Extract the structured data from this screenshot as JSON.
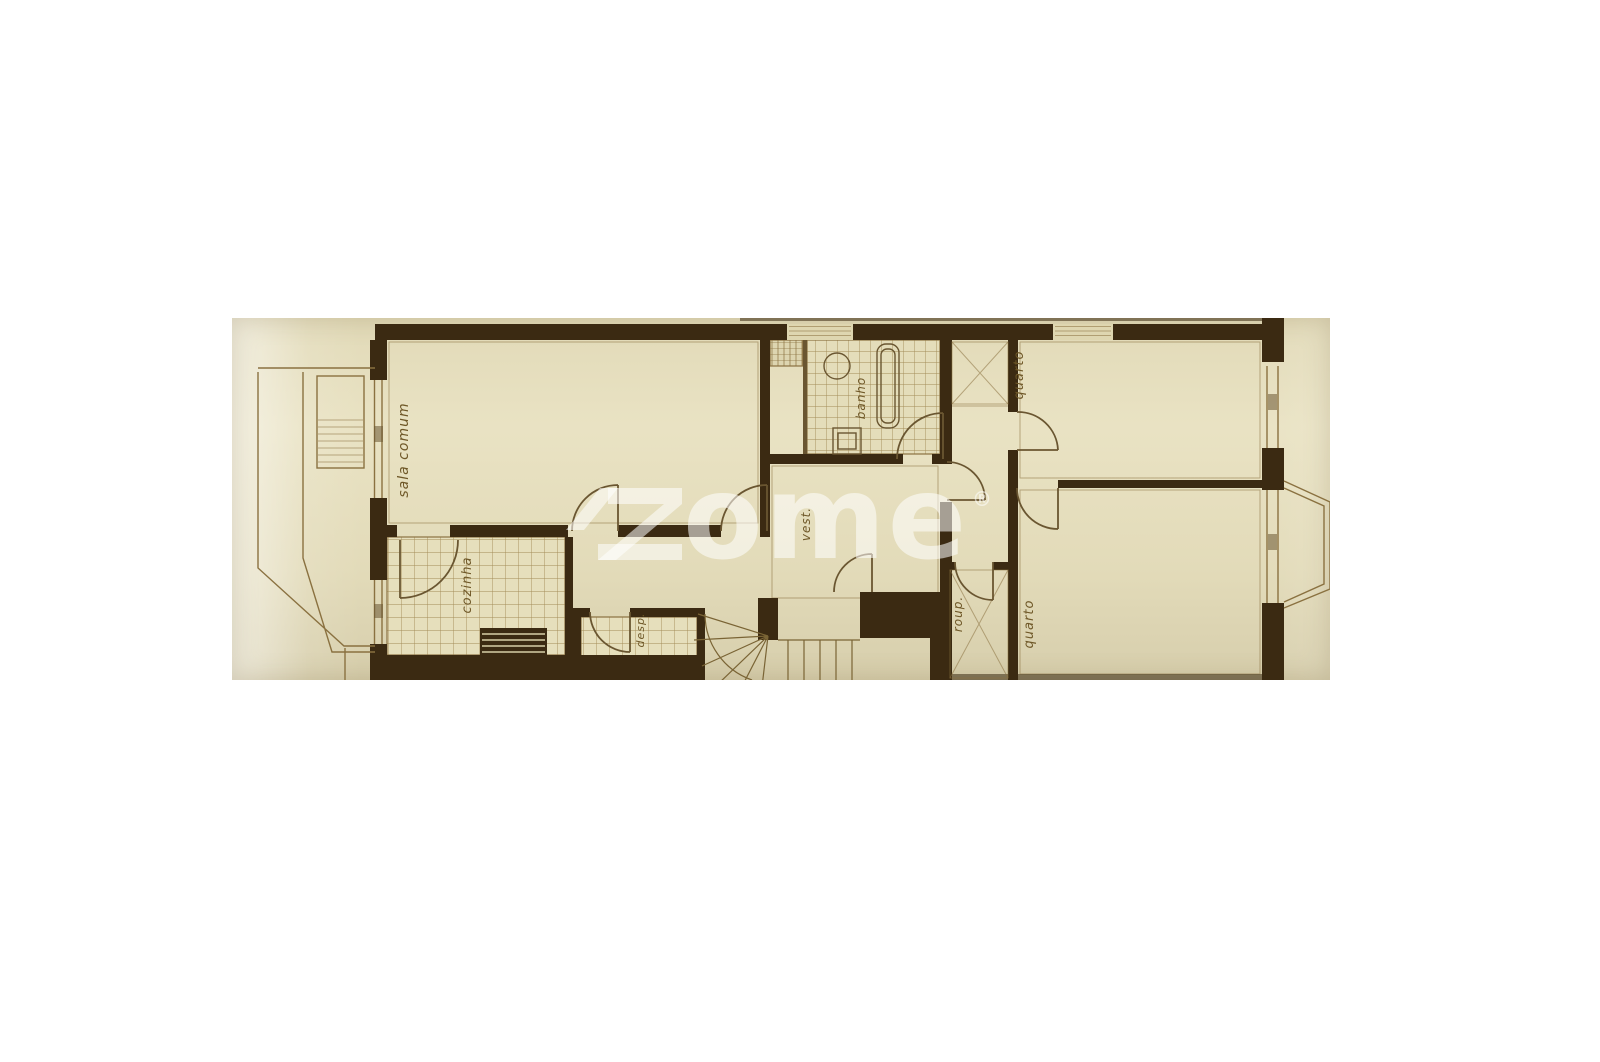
{
  "colors": {
    "page_bg": "#ffffff",
    "photo_bg": "#e8e1c0",
    "wall": "#3b2a12",
    "line": "#8a7140",
    "tile_line": "#a28b56",
    "label": "#6f5828",
    "watermark": "rgba(255,255,255,0.55)"
  },
  "photo": {
    "type": "scanned-floor-plan-photo"
  },
  "floorplan": {
    "rooms": [
      {
        "id": "sala-comum",
        "label": "sala comum"
      },
      {
        "id": "cozinha",
        "label": "cozinha"
      },
      {
        "id": "despensa",
        "label": "desp."
      },
      {
        "id": "banho",
        "label": "banho"
      },
      {
        "id": "vestibulo",
        "label": "vest."
      },
      {
        "id": "quarto-1",
        "label": "quarto"
      },
      {
        "id": "roupeiro",
        "label": "roup."
      },
      {
        "id": "quarto-2",
        "label": "quarto"
      }
    ]
  },
  "watermark": {
    "text": "zome",
    "tail": "ome",
    "registered": "®"
  }
}
